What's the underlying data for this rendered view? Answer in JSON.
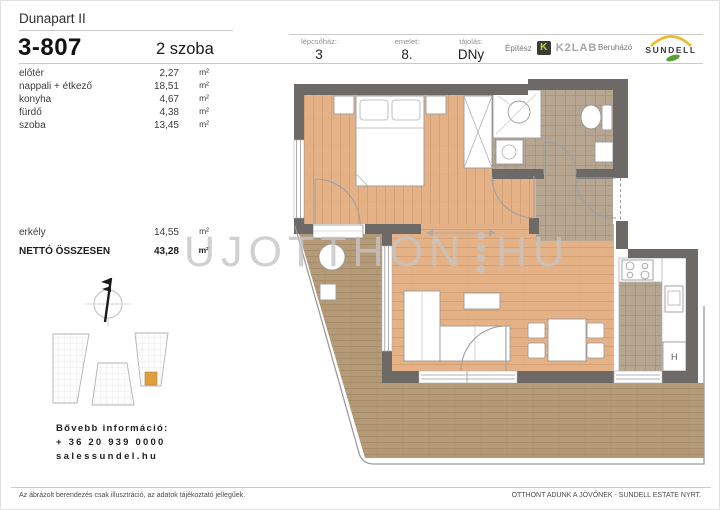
{
  "header": {
    "project": "Dunapart II",
    "unit": "3-807",
    "room_count": "2 szoba",
    "columns": [
      {
        "label": "lépcsőház:",
        "value": "3"
      },
      {
        "label": "emelet:",
        "value": "8."
      },
      {
        "label": "tájolás:",
        "value": "DNy"
      }
    ],
    "architect_label": "Építész",
    "architect_logo_letter": "K",
    "architect_name": "K2LAB",
    "developer_label": "Beruházó",
    "developer_name": "SUNDELL"
  },
  "rooms": [
    {
      "name": "előtér",
      "value": "2,27",
      "unit": "m²"
    },
    {
      "name": "nappali + étkező",
      "value": "18,51",
      "unit": "m²"
    },
    {
      "name": "konyha",
      "value": "4,67",
      "unit": "m²"
    },
    {
      "name": "fürdő",
      "value": "4,38",
      "unit": "m²"
    },
    {
      "name": "szoba",
      "value": "13,45",
      "unit": "m²"
    }
  ],
  "balcony_row": {
    "name": "erkély",
    "value": "14,55",
    "unit": "m²"
  },
  "total_row": {
    "name": "NETTÓ ÖSSZESEN",
    "value": "43,28",
    "unit": "m²"
  },
  "plan": {
    "fridge_label": "H"
  },
  "watermark": {
    "left": "UJOTTHON",
    "right": "HU"
  },
  "contact": {
    "title": "Bővebb információ:",
    "phone": "+ 36 20 939 0000",
    "web": "salessundel.hu"
  },
  "footer": {
    "disclaimer": "Az ábrázolt berendezés csak illusztráció, az adatok tájékoztató jellegűek.",
    "company": "OTTHONT ADUNK A JÖVŐNEK - SUNDELL ESTATE NYRT."
  },
  "colors": {
    "wood": "#e5b288",
    "deck": "#b49a76",
    "tile": "#b5a591",
    "wall": "#6c6966",
    "unit_highlight": "#e09f3e",
    "logo_yellow": "#f0b928",
    "logo_green": "#5aa02e"
  }
}
